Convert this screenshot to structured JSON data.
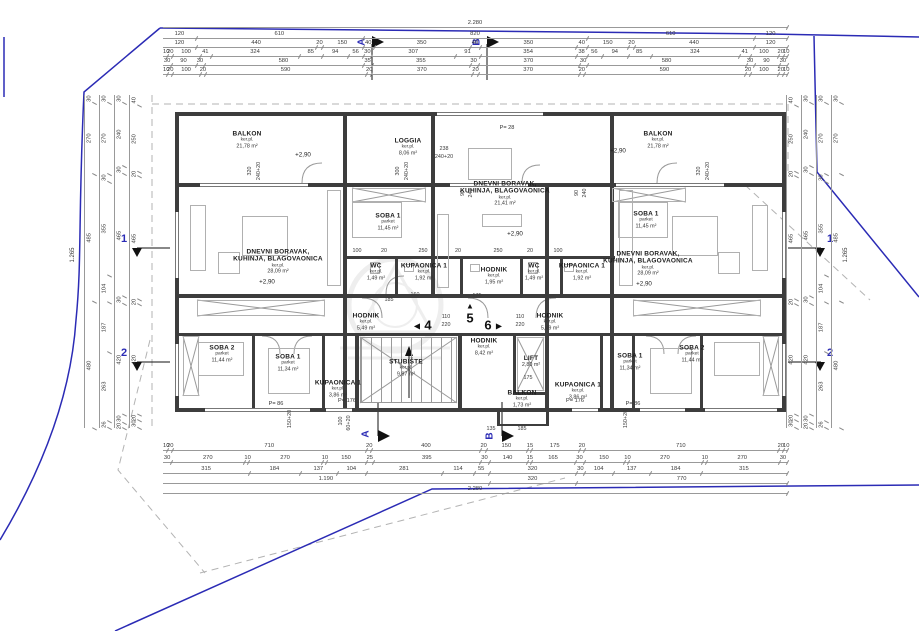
{
  "meta": {
    "drawing_type": "floor-plan",
    "colors": {
      "boundary_blue": "#2b2bb5",
      "wall": "#3d3d3d",
      "dim_text": "#3a3a3a",
      "furniture": "#b0b0b0"
    }
  },
  "rooms": [
    {
      "name": "BALKON",
      "sub": "ker.pl.",
      "area": "21,78 m²"
    },
    {
      "name": "LOGGIA",
      "sub": "ker.pl.",
      "area": "8,06 m²"
    },
    {
      "name": "BALKON",
      "sub": "ker.pl.",
      "area": "21,78 m²"
    },
    {
      "name": "DNEVNI BORAVAK,\nKUHINJA, BLAGOVAONICA",
      "sub": "ker.pl.",
      "area": "28,09 m²"
    },
    {
      "name": "DNEVNI BORAVAK,\nKUHINJA, BLAGOVAONICA",
      "sub": "ker.pl.",
      "area": "21,41 m²"
    },
    {
      "name": "DNEVNI BORAVAK,\nKUHINJA, BLAGOVAONICA",
      "sub": "ker.pl.",
      "area": "28,09 m²"
    },
    {
      "name": "SOBA 1",
      "sub": "parket",
      "area": "11,45 m²"
    },
    {
      "name": "SOBA 1",
      "sub": "parket",
      "area": "11,45 m²"
    },
    {
      "name": "WC",
      "sub": "ker.pl.",
      "area": "1,49 m²"
    },
    {
      "name": "KUPAONICA 1",
      "sub": "ker.pl.",
      "area": "1,92 m²"
    },
    {
      "name": "HODNIK",
      "sub": "ker.pl.",
      "area": "1,95 m²"
    },
    {
      "name": "WC",
      "sub": "ker.pl.",
      "area": "1,49 m²"
    },
    {
      "name": "KUPAONICA 1",
      "sub": "ker.pl.",
      "area": "1,92 m²"
    },
    {
      "name": "HODNIK",
      "sub": "ker.pl.",
      "area": "5,49 m²"
    },
    {
      "name": "HODNIK",
      "sub": "ker.pl.",
      "area": "5,49 m²"
    },
    {
      "name": "HODNIK",
      "sub": "ker.pl.",
      "area": "8,42 m²"
    },
    {
      "name": "STUBIŠTE",
      "sub": "ker.pl.",
      "area": "9,87 m²"
    },
    {
      "name": "LIFT",
      "sub": "",
      "area": "2,80 m²"
    },
    {
      "name": "BALKON",
      "sub": "ker.pl.",
      "area": "1,73 m²"
    },
    {
      "name": "KUPAONICA 1",
      "sub": "ker.pl.",
      "area": "3,86 m²"
    },
    {
      "name": "KUPAONICA 1",
      "sub": "ker.pl.",
      "area": "3,86 m²"
    },
    {
      "name": "SOBA 2",
      "sub": "parket",
      "area": "11,44 m²"
    },
    {
      "name": "SOBA 1",
      "sub": "parket",
      "area": "11,34 m²"
    },
    {
      "name": "SOBA 1",
      "sub": "parket",
      "area": "11,34 m²"
    },
    {
      "name": "SOBA 2",
      "sub": "parket",
      "area": "11,44 m²"
    }
  ],
  "levels": {
    "label": "+2,90"
  },
  "parapets": {
    "p28": "P= 28",
    "p86": "P= 86",
    "p176": "P= 176"
  },
  "apartments": {
    "a4": "4",
    "a5": "5",
    "a6": "6",
    "tri_left": "◀",
    "tri_up": "▲",
    "tri_right": "▶"
  },
  "sections": {
    "s1": "1",
    "s2": "2",
    "sA": "A",
    "sB": "B"
  },
  "totals": {
    "width": "2.280",
    "height": "1.265"
  },
  "dims": {
    "top": [
      [
        "2.280"
      ],
      [
        "120",
        "610",
        "820",
        "610",
        "120"
      ],
      [
        "120",
        "440",
        "20",
        "150",
        "40",
        "350",
        "40",
        "350",
        "40",
        "150",
        "20",
        "440",
        "120"
      ],
      [
        "10",
        "20",
        "100",
        "41",
        "324",
        "85",
        "94",
        "56",
        "30",
        "307",
        "91",
        "354",
        "38",
        "56",
        "94",
        "85",
        "324",
        "41",
        "100",
        "20",
        "10"
      ],
      [
        "30",
        "90",
        "30",
        "580",
        "35",
        "355",
        "30",
        "370",
        "30",
        "580",
        "30",
        "90",
        "30"
      ],
      [
        "10",
        "20",
        "100",
        "20",
        "590",
        "20",
        "370",
        "20",
        "370",
        "20",
        "590",
        "20",
        "100",
        "20",
        "10"
      ]
    ],
    "bottom": [
      [
        "10",
        "20",
        "710",
        "20",
        "400",
        "20",
        "150",
        "15",
        "175",
        "20",
        "710",
        "20",
        "10"
      ],
      [
        "30",
        "270",
        "10",
        "270",
        "10",
        "150",
        "25",
        "395",
        "30",
        "140",
        "15",
        "165",
        "30",
        "150",
        "10",
        "270",
        "10",
        "270",
        "30"
      ],
      [
        "315",
        "184",
        "137",
        "104",
        "281",
        "114",
        "55",
        "320",
        "30",
        "104",
        "137",
        "184",
        "315"
      ],
      [
        "1.190",
        "320",
        "770"
      ],
      [
        "2.280"
      ]
    ],
    "left": [
      [
        "30",
        "270",
        "485",
        "480"
      ],
      [
        "30",
        "270",
        "30",
        "355",
        "104",
        "187",
        "263",
        "26"
      ],
      [
        "30",
        "240",
        "30",
        "465",
        "30",
        "420",
        "30",
        "20"
      ],
      [
        "40",
        "250",
        "20",
        "465",
        "20",
        "420",
        "20",
        "30"
      ]
    ],
    "right": [
      [
        "40",
        "250",
        "20",
        "465",
        "20",
        "420",
        "20",
        "30"
      ],
      [
        "30",
        "240",
        "30",
        "465",
        "30",
        "420",
        "30",
        "20"
      ],
      [
        "30",
        "270",
        "30",
        "355",
        "104",
        "187",
        "263",
        "26"
      ],
      [
        "30",
        "270",
        "485",
        "480"
      ]
    ],
    "inner": [
      "320",
      "240+20",
      "300",
      "240+20",
      "238",
      "240+20",
      "320",
      "240+20",
      "90",
      "240",
      "90",
      "240",
      "100",
      "20",
      "250",
      "20",
      "250",
      "20",
      "100",
      "160",
      "175",
      "185",
      "110",
      "220",
      "110",
      "220",
      "175",
      "135",
      "185",
      "150+20",
      "150+20",
      "100",
      "60+20"
    ]
  }
}
